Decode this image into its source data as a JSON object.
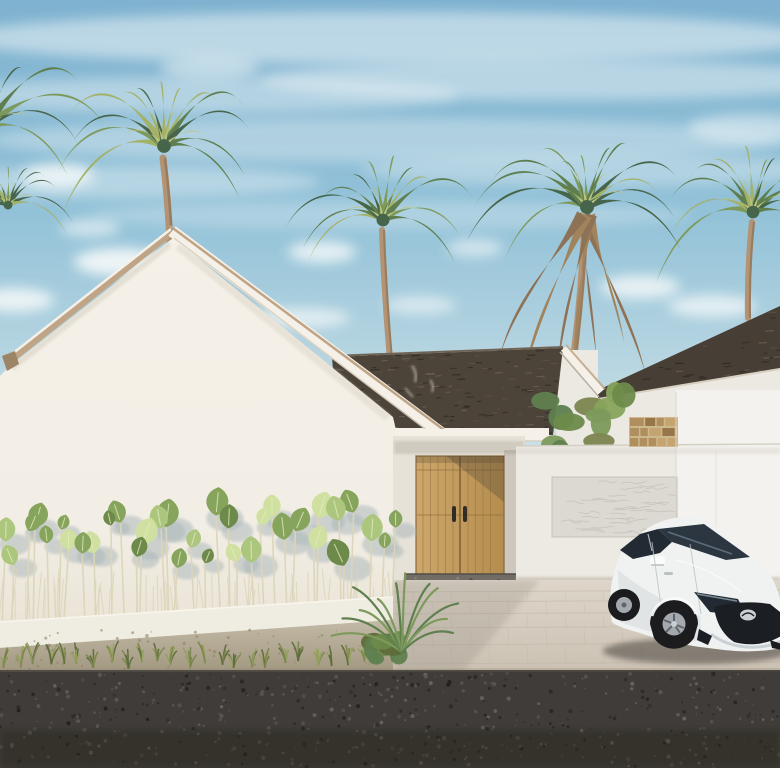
{
  "meta": {
    "title": "3D exterior render of a white tropical minimalist villa with palm trees, wooden double entry door, garden hedge and white parked hatchback",
    "scene_type": "architectural-render"
  },
  "palette": {
    "sky_top": "#7fb2d0",
    "sky_mid": "#93c2d8",
    "sky_low": "#bad7e2",
    "sky_horizon": "#d2e4ea",
    "cloud": "#f5f9f9",
    "wall": "#f2eee5",
    "wall_top": "#f5f1e8",
    "wall_bottom": "#eae4d6",
    "wall_shade": "#e6e1d5",
    "entry_wall": "#e7e2d8",
    "fascia": "#f5f1e9",
    "fascia_tan": "#bfa485",
    "fascia_dark": "#9c8466",
    "fascia_shadow": "#d7cfc0",
    "roof_dark": "#4c4339",
    "roof_mid": "#5d5246",
    "roof_light": "#6f6355",
    "roof_deep": "#332c26",
    "roof_smudge": "#d9d4c9",
    "nb_roof": "#473e35",
    "nb_wall": "#ece9e2",
    "door_light": "#cda76b",
    "door_dark": "#b48d4e",
    "door_line": "#96743f",
    "door_edge": "#8a6a3c",
    "handle": "#332c24",
    "threshold": "#716d65",
    "threshold_dot": "#524f48",
    "threshold_dot2": "#8c8880",
    "fence": "#edeae4",
    "fence_bright": "#f4f2ee",
    "fence_seam": "#dcd7cf",
    "panel": "#dcd8d2",
    "panel_line": "#c6c2bb",
    "stone_mortar": "#ceb98f",
    "stone1": "#b08e5e",
    "stone2": "#97764a",
    "stone3": "#c5a470",
    "drive_top": "#ded6ca",
    "drive_bottom": "#cbc1b3",
    "joint": "#bfb3a3",
    "drive_shadow": "#8f897d",
    "curb": "#efece2",
    "curb_shade": "#d9d4c6",
    "curb_hi": "#f8f5ec",
    "dirt_top": "#c3baa7",
    "dirt_bottom": "#a0967f",
    "dirt_fleck": "#8d8267",
    "gravel": "#403c39",
    "gravel_dark": "#2b2825",
    "gravel_deep": "#232019",
    "gravel_light": "#5d5853",
    "gravel_light2": "#6e6861",
    "road_edge": "#847b69",
    "grass1": "#7c864f",
    "grass2": "#5f6b3c",
    "grass3": "#93a05e",
    "leaf_light": "#cfe0a0",
    "leaf_mid": "#adc67e",
    "leaf_dark": "#87a45c",
    "leaf_deep": "#6d8a4a",
    "vein": "#e3edbd",
    "stem": "#dcd5ba",
    "leaf_shadow": "#a9b6b9",
    "palm_dark": "#46654a",
    "palm_mid": "#5f7f4f",
    "palm_light": "#7d9a5c",
    "palm_yellow": "#a3b169",
    "palm_pale": "#bcc47e",
    "trunk": "#b29374",
    "trunk_dark": "#8e7256",
    "skirt": "#a1835c",
    "car_body": "#f0f2f2",
    "car_shade": "#d4d9da",
    "car_dark": "#b9c0c2",
    "car_hi": "#fafbfb",
    "glass": "#2c3640",
    "glass_dark": "#222b33",
    "chrome": "#c9d0d4",
    "grille": "#1b1e22",
    "tire": "#1c1c1f",
    "rim": "#a3a9ae",
    "rim_dark": "#5f656a",
    "ground_shadow": "#2a2622"
  },
  "scene": {
    "clouds": [
      {
        "x": 390,
        "y": 38,
        "rx": 430,
        "ry": 26,
        "o": 0.5
      },
      {
        "x": 200,
        "y": 95,
        "rx": 260,
        "ry": 18,
        "o": 0.4
      },
      {
        "x": 560,
        "y": 80,
        "rx": 300,
        "ry": 20,
        "o": 0.45
      },
      {
        "x": 390,
        "y": 140,
        "rx": 400,
        "ry": 22,
        "o": 0.34
      },
      {
        "x": 120,
        "y": 182,
        "rx": 200,
        "ry": 16,
        "o": 0.38
      },
      {
        "x": 600,
        "y": 170,
        "rx": 240,
        "ry": 16,
        "o": 0.34
      },
      {
        "x": 390,
        "y": 215,
        "rx": 300,
        "ry": 14,
        "o": 0.28
      },
      {
        "x": 58,
        "y": 176,
        "rx": 36,
        "ry": 12,
        "o": 0.8
      },
      {
        "x": 120,
        "y": 262,
        "rx": 46,
        "ry": 14,
        "o": 0.9
      },
      {
        "x": 14,
        "y": 300,
        "rx": 40,
        "ry": 12,
        "o": 0.85
      },
      {
        "x": 322,
        "y": 252,
        "rx": 34,
        "ry": 11,
        "o": 0.8
      },
      {
        "x": 300,
        "y": 318,
        "rx": 50,
        "ry": 10,
        "o": 0.7
      },
      {
        "x": 475,
        "y": 248,
        "rx": 28,
        "ry": 9,
        "o": 0.6
      },
      {
        "x": 640,
        "y": 287,
        "rx": 40,
        "ry": 12,
        "o": 0.8
      },
      {
        "x": 712,
        "y": 306,
        "rx": 44,
        "ry": 11,
        "o": 0.75
      },
      {
        "x": 748,
        "y": 128,
        "rx": 60,
        "ry": 14,
        "o": 0.5
      },
      {
        "x": 210,
        "y": 68,
        "rx": 50,
        "ry": 12,
        "o": 0.5
      },
      {
        "x": 90,
        "y": 228,
        "rx": 30,
        "ry": 9,
        "o": 0.6
      },
      {
        "x": 420,
        "y": 305,
        "rx": 36,
        "ry": 9,
        "o": 0.6
      }
    ],
    "palms": [
      {
        "name": "palm-left-edge-upper",
        "cx": -14,
        "cy": 128,
        "r": 108,
        "fronds": 13,
        "seed": 101,
        "dark": true,
        "skirt": false,
        "trunk": null
      },
      {
        "name": "palm-left-edge-lower",
        "cx": 8,
        "cy": 205,
        "r": 64,
        "fronds": 11,
        "seed": 106,
        "dark": true,
        "skirt": false,
        "trunk": null
      },
      {
        "name": "palm-behind-gable",
        "cx": 164,
        "cy": 146,
        "r": 98,
        "fronds": 13,
        "seed": 102,
        "dark": false,
        "skirt": false,
        "trunk": {
          "x1": 170,
          "y1": 242,
          "x2": 163,
          "y2": 158,
          "w": 7
        }
      },
      {
        "name": "palm-center",
        "cx": 383,
        "cy": 220,
        "r": 92,
        "fronds": 12,
        "seed": 103,
        "dark": false,
        "skirt": false,
        "trunk": {
          "x1": 390,
          "y1": 360,
          "x2": 382,
          "y2": 230,
          "w": 6
        }
      },
      {
        "name": "palm-tall-shaggy",
        "cx": 587,
        "cy": 207,
        "r": 100,
        "fronds": 13,
        "seed": 104,
        "dark": false,
        "skirt": true,
        "trunk": {
          "x1": 571,
          "y1": 378,
          "x2": 585,
          "y2": 218,
          "w": 7
        }
      },
      {
        "name": "palm-right",
        "cx": 753,
        "cy": 212,
        "r": 90,
        "fronds": 12,
        "seed": 105,
        "dark": false,
        "skirt": false,
        "trunk": {
          "x1": 748,
          "y1": 318,
          "x2": 752,
          "y2": 222,
          "w": 6
        }
      }
    ],
    "hedge": {
      "x0": 2,
      "x1": 394,
      "leaves": 34,
      "extra_stems": 55,
      "base_y": 620,
      "seed": 41
    },
    "grass": {
      "x0": 2,
      "x1": 393,
      "tufts": 26,
      "base_y": 661,
      "seed": 31
    },
    "gravel": {
      "x0": 0,
      "x1": 780,
      "y0": 673,
      "y1": 767,
      "count": 560,
      "seed": 21
    },
    "dirt_flecks": {
      "count": 60,
      "seed": 51
    },
    "panel_scribbles": {
      "count": 36,
      "seed": 61
    },
    "threshold_pebbles": {
      "count": 40,
      "seed": 71
    },
    "stone_block": {
      "x": 629,
      "y": 417,
      "w": 49,
      "h": 30,
      "rows": 3,
      "seed": 81
    },
    "mid_roof_shingles": {
      "count": 150,
      "seed": 91
    },
    "nb_roof_shingles": {
      "count": 70,
      "seed": 92
    },
    "drive_joints": {
      "ys": [
        592,
        602,
        614,
        628,
        645,
        664
      ],
      "x0": 393,
      "x1": 780
    },
    "shrub": {
      "x0": 540,
      "x1": 624,
      "y0": 388,
      "y1": 454,
      "blobs": 12,
      "seed": 93
    },
    "dracaena": {
      "bx": 402,
      "by": 652,
      "blades": 12,
      "seed": 94
    }
  }
}
